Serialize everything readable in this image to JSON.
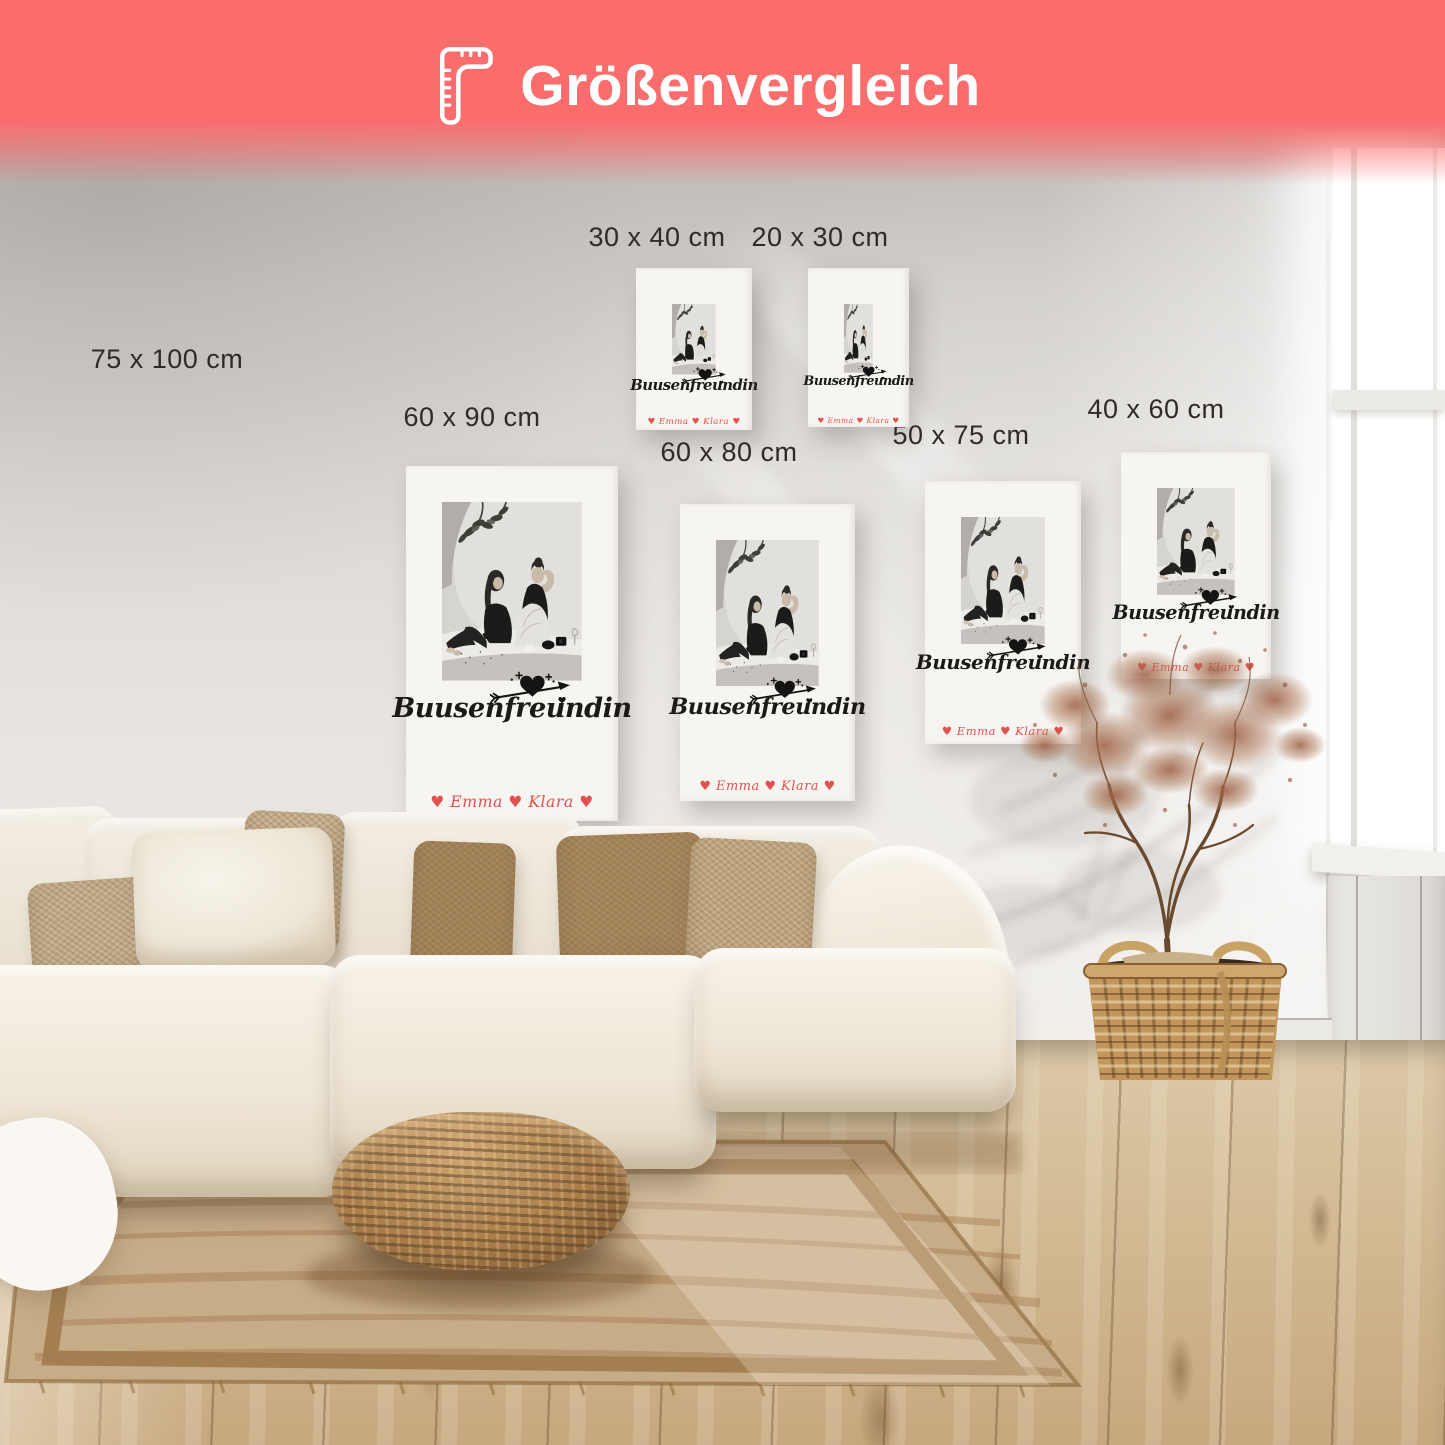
{
  "header": {
    "title": "Größenvergleich",
    "icon": "ruler-icon"
  },
  "poster_design": {
    "title": "Buusenfreundin",
    "names_line": "♥ Emma ♥ Klara ♥",
    "motif": "heart-with-arrow"
  },
  "size_labels": [
    "75 x 100 cm",
    "30 x 40 cm",
    "20 x 30 cm",
    "60 x 90 cm",
    "60 x 80 cm",
    "50 x 75 cm",
    "40 x 60 cm"
  ],
  "colors": {
    "header_bg": "#fb6d6d",
    "header_text": "#ffffff",
    "poster_title_ink": "#1c1a18",
    "names_accent": "#e0524e"
  }
}
